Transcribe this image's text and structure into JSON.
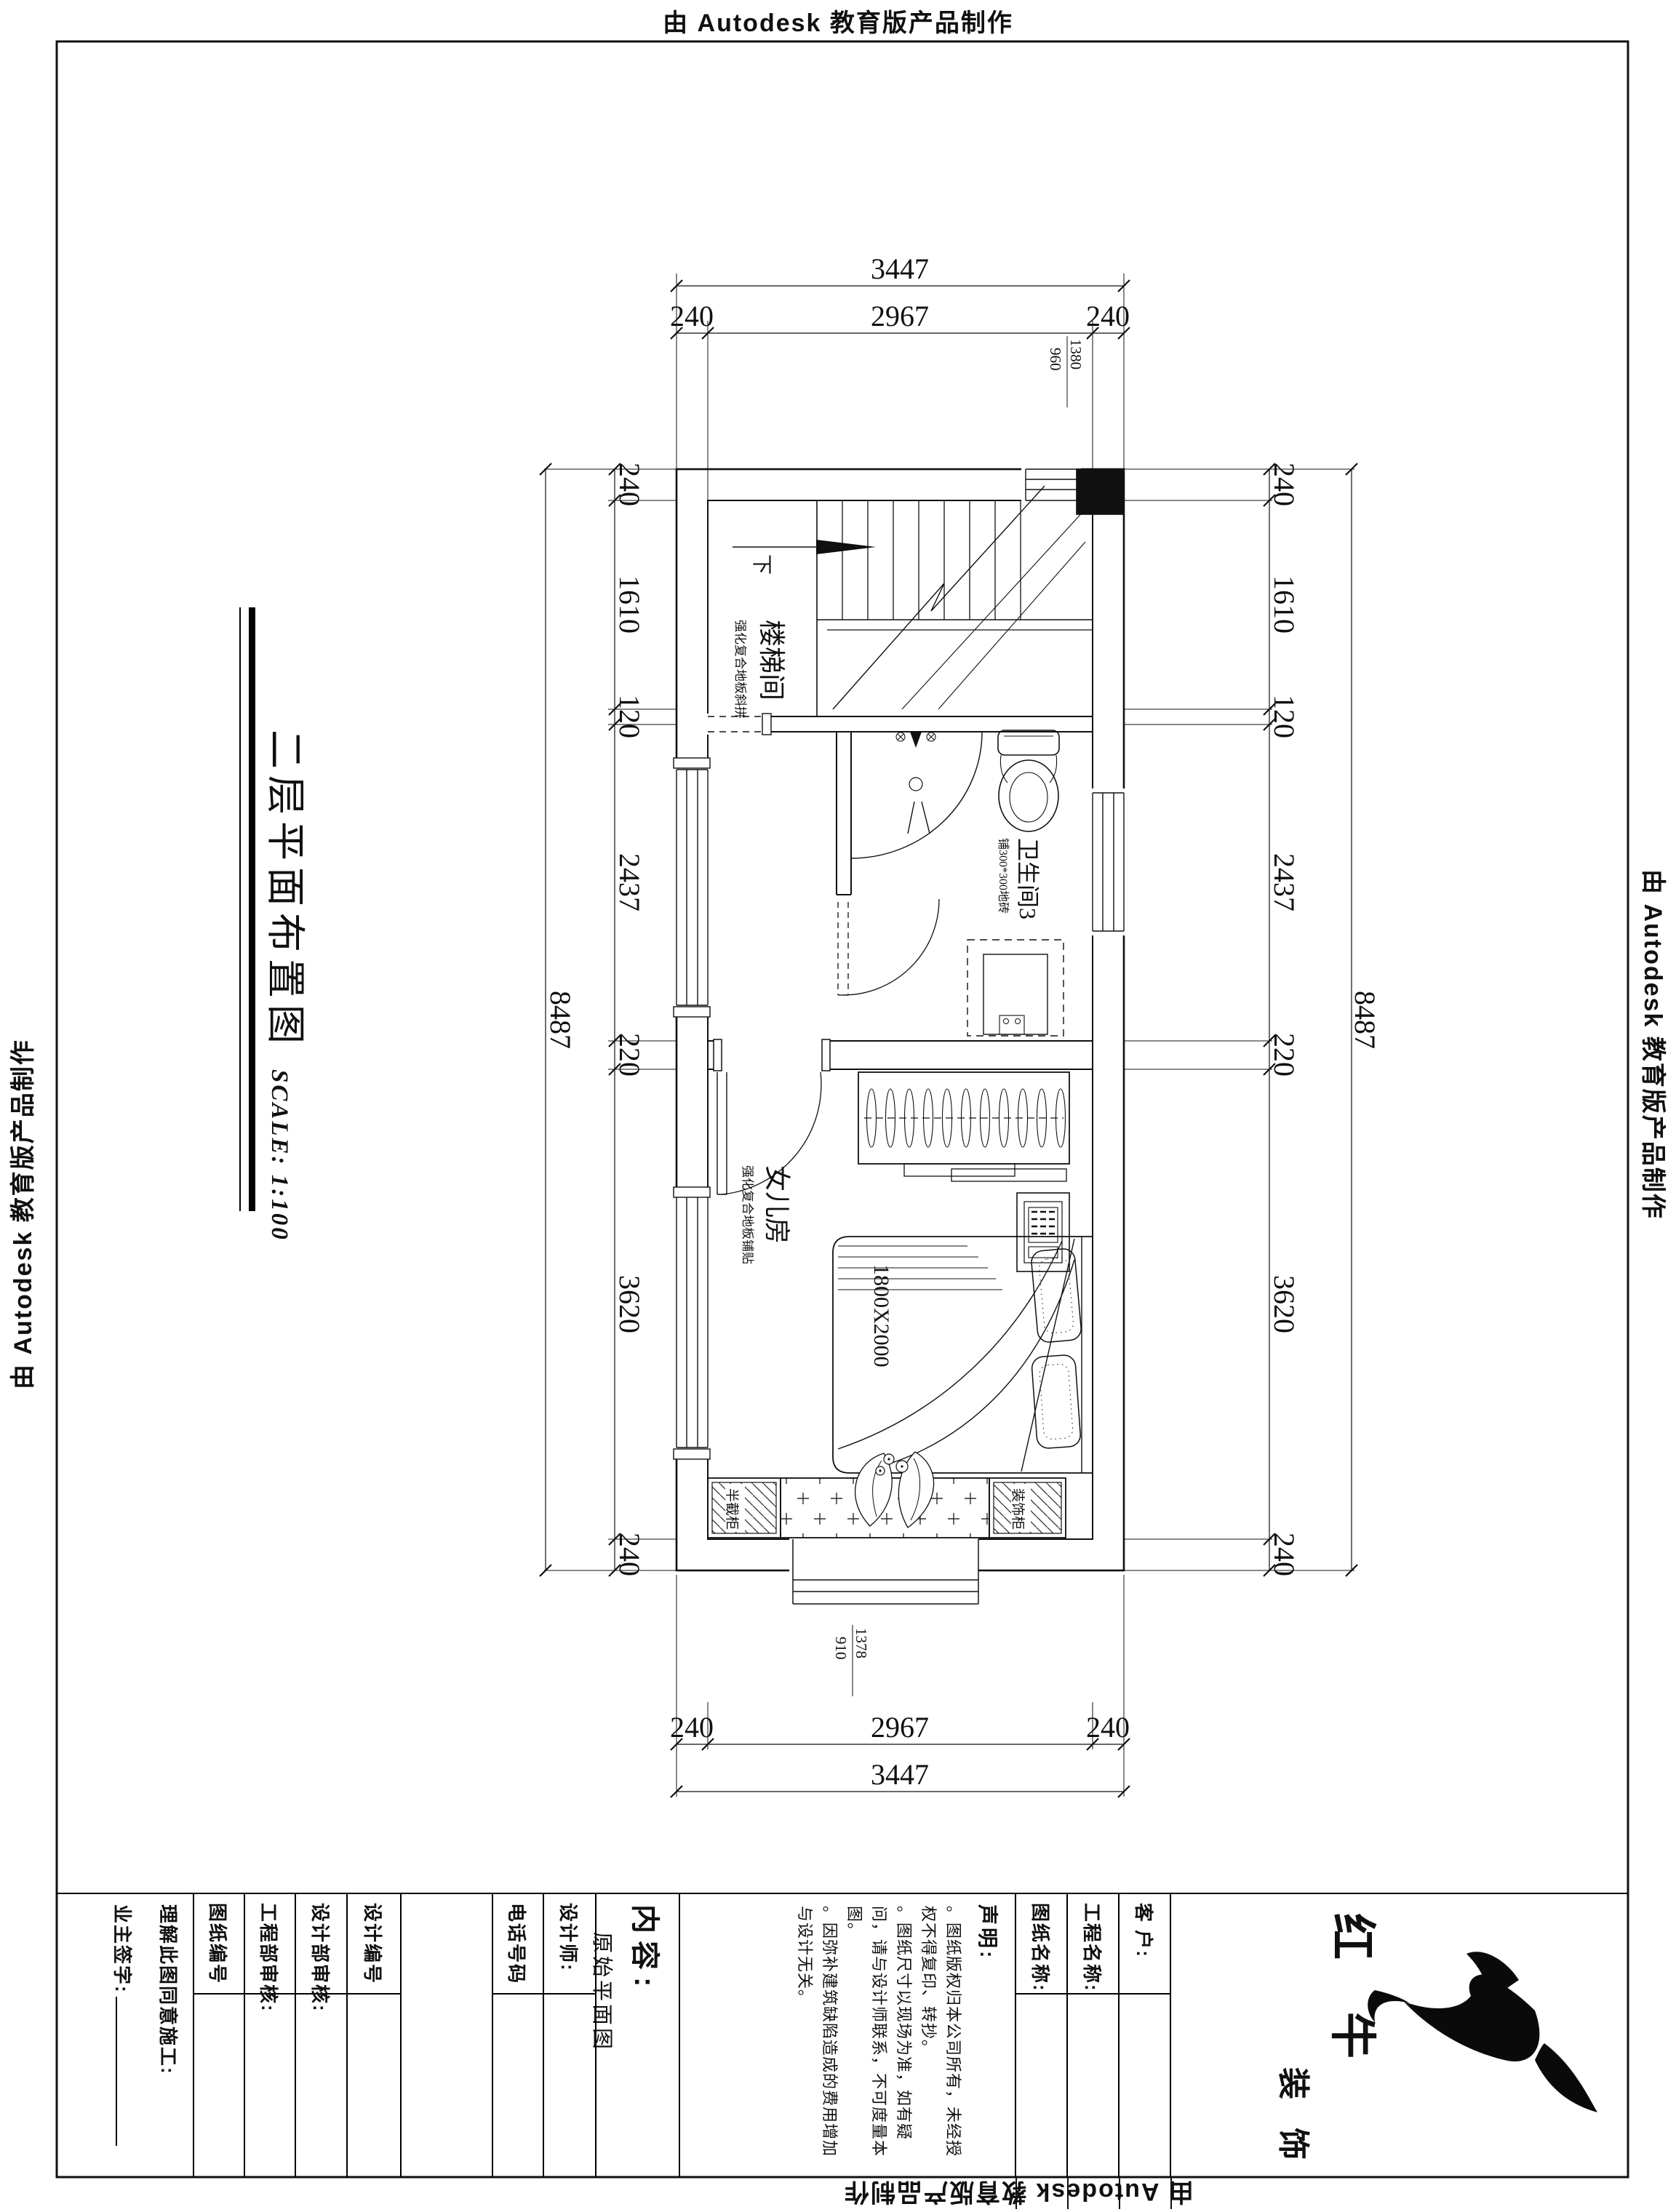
{
  "stamp": {
    "text": "由 Autodesk 教育版产品制作"
  },
  "title": {
    "text": "二层平面布置图",
    "scale": "SCALE: 1:100"
  },
  "plan": {
    "stairwell": {
      "name": "楼梯间",
      "finish": "强化复合地板斜拼",
      "down": "下"
    },
    "bathroom": {
      "name": "卫生间3",
      "finish": "铺300*300地砖"
    },
    "bedroom": {
      "name": "女儿房",
      "finish": "强化复合地板铺贴",
      "bed": "1800X2000"
    },
    "cabinet_left": "半截柜",
    "cabinet_right": "装饰柜",
    "win_top": {
      "a": "1380",
      "b": "960"
    },
    "win_bottom": {
      "a": "1378",
      "b": "910"
    }
  },
  "dims": {
    "top": {
      "overall": "3447",
      "parts": [
        "240",
        "2967",
        "240"
      ]
    },
    "bottom": {
      "overall": "3447",
      "parts": [
        "240",
        "2967",
        "240"
      ]
    },
    "left": {
      "overall": "8487",
      "parts": [
        "240",
        "1610",
        "120",
        "2437",
        "220",
        "3620",
        "240"
      ]
    },
    "right": {
      "overall": "8487",
      "parts": [
        "240",
        "1610",
        "120",
        "2437",
        "220",
        "3620",
        "240"
      ]
    }
  },
  "tb": {
    "owner_sign": "业主签字:",
    "agree": "理解此图同意施工:",
    "sheet_no": "图纸编号",
    "eng_audit": "工程部审核:",
    "design_audit": "设计部审核:",
    "design_no": "设计编号",
    "phone": "电话号码",
    "designer": "设计师:",
    "content_label": "内容:",
    "content_value": "原始平面图",
    "declare_label": "声明:",
    "declare": [
      "。图纸版权归本公司所有，未经授权不得复印、转抄。",
      "。图纸尺寸以现场为准，如有疑问，请与设计师联系，不可度量本图。",
      "。因弥补建筑缺陷造成的费用增加与设计无关。"
    ],
    "sheet_name": "图纸名称:",
    "project_name": "工程名称:",
    "client": "客 户:",
    "brand_1": "红 牛",
    "brand_2": "装 饰"
  }
}
